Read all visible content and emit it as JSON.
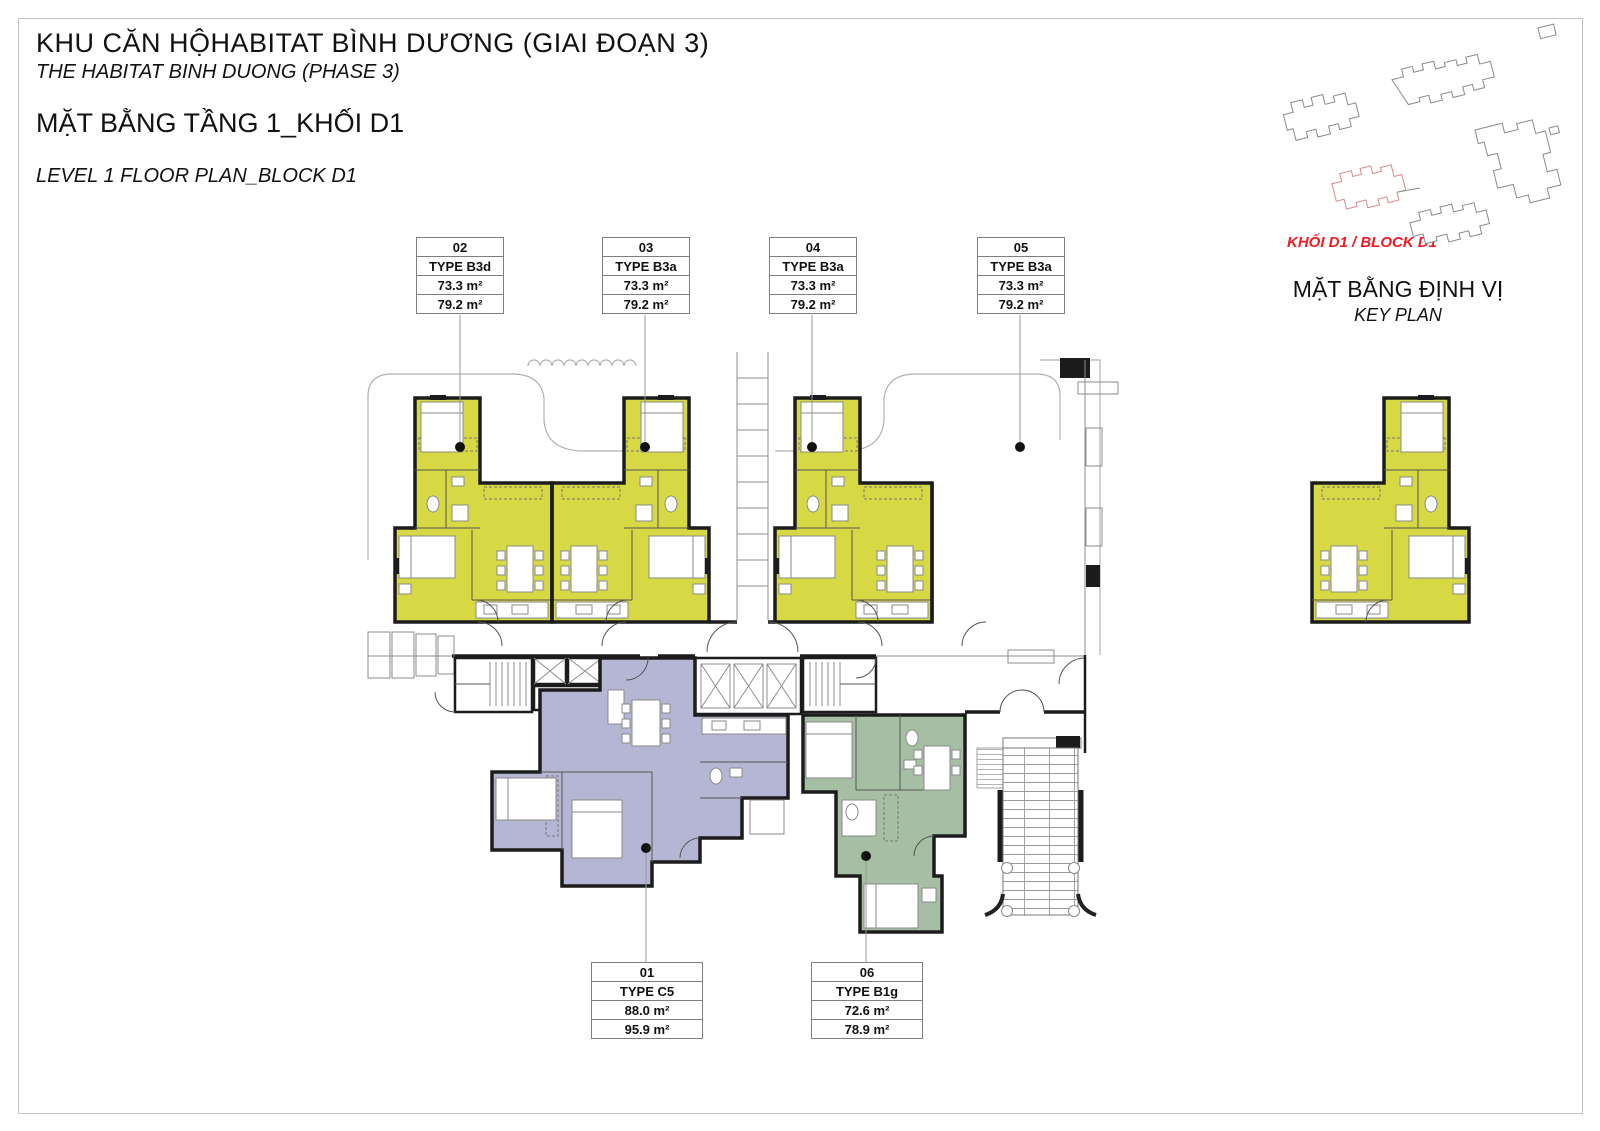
{
  "header": {
    "title_vi": "KHU CĂN HỘHABITAT BÌNH DƯƠNG (GIAI ĐOẠN 3)",
    "title_en": "THE HABITAT BINH DUONG (PHASE 3)",
    "subtitle_vi": "MẶT BẰNG TẦNG 1_KHỐI D1",
    "subtitle_en": "LEVEL 1 FLOOR PLAN_BLOCK D1"
  },
  "key_plan": {
    "highlight_label": "KHỐI D1 / BLOCK D1",
    "title_vi": "MẶT BẰNG ĐỊNH VỊ",
    "title_en": "KEY PLAN"
  },
  "units": [
    {
      "number": "01",
      "type": "TYPE C5",
      "area_net": "88.0 m²",
      "area_gross": "95.9 m²",
      "color": "#b4b6d3"
    },
    {
      "number": "02",
      "type": "TYPE B3d",
      "area_net": "73.3 m²",
      "area_gross": "79.2 m²",
      "color": "#d7d944"
    },
    {
      "number": "03",
      "type": "TYPE B3a",
      "area_net": "73.3 m²",
      "area_gross": "79.2 m²",
      "color": "#d7d944"
    },
    {
      "number": "04",
      "type": "TYPE B3a",
      "area_net": "73.3 m²",
      "area_gross": "79.2 m²",
      "color": "#d7d944"
    },
    {
      "number": "05",
      "type": "TYPE B3a",
      "area_net": "73.3 m²",
      "area_gross": "79.2 m²",
      "color": "#d7d944"
    },
    {
      "number": "06",
      "type": "TYPE B1g",
      "area_net": "72.6 m²",
      "area_gross": "78.9 m²",
      "color": "#a6bfa4"
    }
  ],
  "colors": {
    "wall": "#1c1c1c",
    "highlight_red": "#ed1c24",
    "leader": "#9a9a9a",
    "frame": "#c2c2c2"
  }
}
